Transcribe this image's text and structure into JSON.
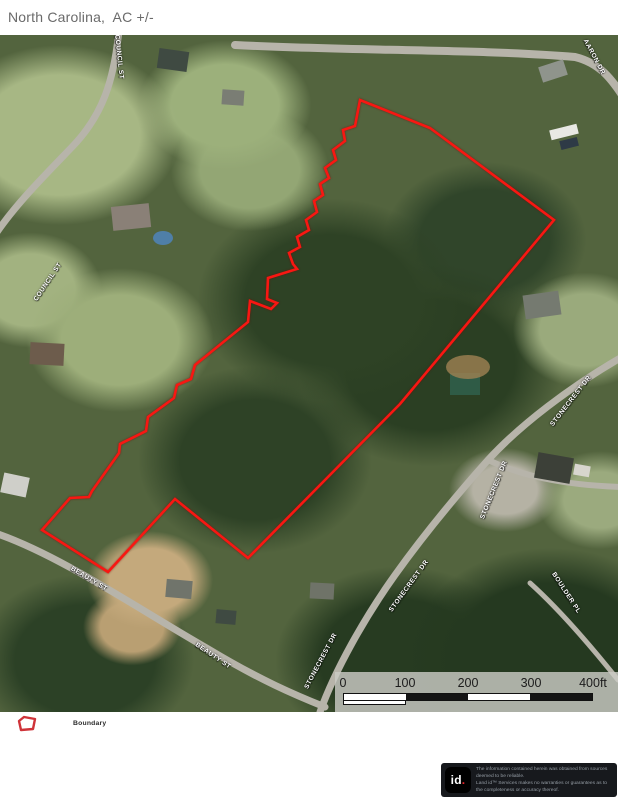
{
  "header": {
    "title": "North Carolina,  AC +/-"
  },
  "map": {
    "street_labels": [
      {
        "text": "COUNCIL ST",
        "x": 119,
        "y": 22,
        "rotate": 84
      },
      {
        "text": "COUNCIL ST",
        "x": 48,
        "y": 247,
        "rotate": -56
      },
      {
        "text": "AARON DR",
        "x": 594,
        "y": 22,
        "rotate": 62
      },
      {
        "text": "STONECREST DR",
        "x": 571,
        "y": 366,
        "rotate": -52
      },
      {
        "text": "STONECREST DR",
        "x": 494,
        "y": 455,
        "rotate": -68
      },
      {
        "text": "STONECREST DR",
        "x": 409,
        "y": 551,
        "rotate": -54
      },
      {
        "text": "STONECREST DR",
        "x": 321,
        "y": 626,
        "rotate": -62
      },
      {
        "text": "BOULDER PL",
        "x": 566,
        "y": 558,
        "rotate": 57
      },
      {
        "text": "BEAUTY ST",
        "x": 89,
        "y": 544,
        "rotate": 31
      },
      {
        "text": "BEAUTY ST",
        "x": 213,
        "y": 621,
        "rotate": 34
      }
    ],
    "boundary": {
      "color": "#f81712",
      "points": [
        [
          360,
          65
        ],
        [
          355,
          91
        ],
        [
          343,
          95
        ],
        [
          345,
          106
        ],
        [
          333,
          115
        ],
        [
          336,
          125
        ],
        [
          325,
          133
        ],
        [
          329,
          143
        ],
        [
          320,
          149
        ],
        [
          323,
          160
        ],
        [
          314,
          166
        ],
        [
          317,
          177
        ],
        [
          306,
          185
        ],
        [
          309,
          195
        ],
        [
          297,
          202
        ],
        [
          300,
          212
        ],
        [
          289,
          218
        ],
        [
          293,
          229
        ],
        [
          297,
          234
        ],
        [
          268,
          243
        ],
        [
          267,
          264
        ],
        [
          277,
          268
        ],
        [
          271,
          274
        ],
        [
          250,
          266
        ],
        [
          248,
          287
        ],
        [
          195,
          330
        ],
        [
          191,
          344
        ],
        [
          177,
          350
        ],
        [
          174,
          363
        ],
        [
          148,
          382
        ],
        [
          146,
          396
        ],
        [
          120,
          409
        ],
        [
          119,
          418
        ],
        [
          92,
          456
        ],
        [
          89,
          462
        ],
        [
          70,
          463
        ],
        [
          42,
          495
        ],
        [
          108,
          537
        ],
        [
          175,
          464
        ],
        [
          248,
          523
        ],
        [
          400,
          369
        ],
        [
          554,
          185
        ],
        [
          430,
          93
        ]
      ]
    },
    "scale_bar": {
      "labels": [
        {
          "text": "0",
          "x": 8
        },
        {
          "text": "100",
          "x": 70
        },
        {
          "text": "200",
          "x": 133
        },
        {
          "text": "300",
          "x": 196
        },
        {
          "text": "400ft",
          "x": 258
        }
      ],
      "segments": [
        "#ffffff",
        "#141414",
        "#ffffff",
        "#141414"
      ]
    }
  },
  "legend": {
    "boundary_label": "Boundary"
  },
  "footer": {
    "logo_text": "id",
    "logo_dot": ".",
    "disclaimer_line1": "The information contained herein was obtained from sources deemed to be reliable.",
    "disclaimer_line2": "Land id™ Services makes no warranties or guarantees as to the completeness or accuracy thereof."
  }
}
